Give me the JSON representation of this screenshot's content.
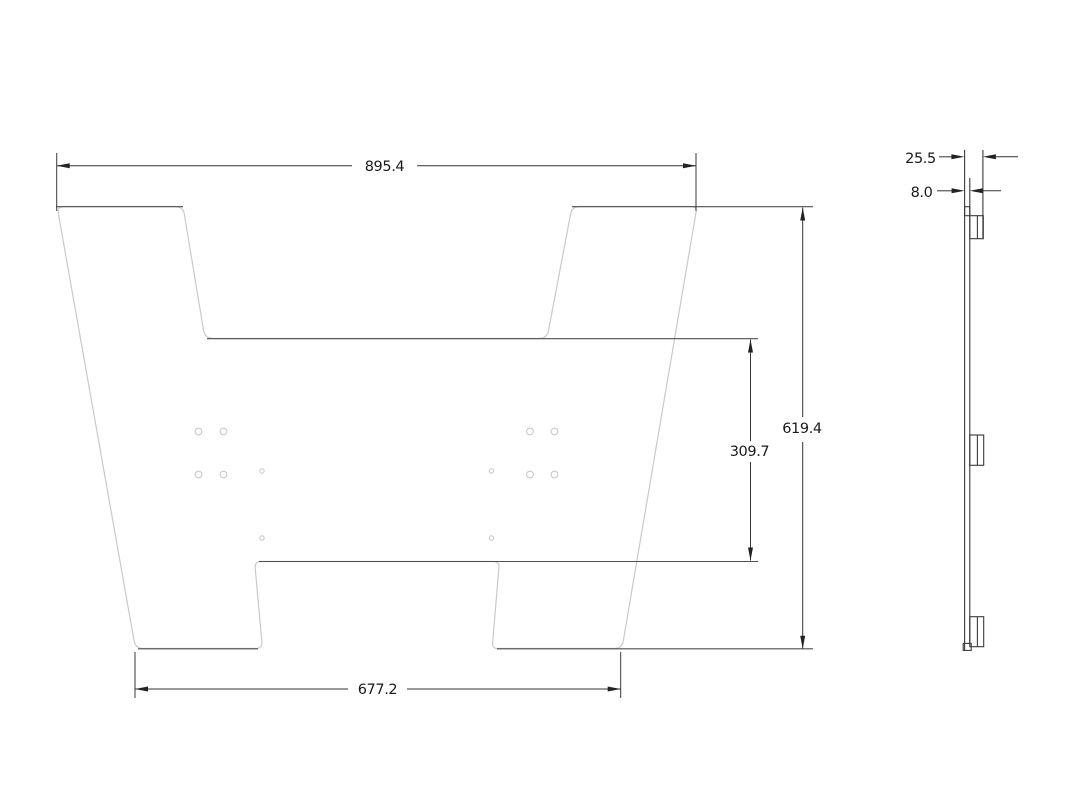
{
  "drawing": {
    "front_view": {
      "top_width": "895.4",
      "overall_height": "619.4",
      "notch_height": "309.7",
      "bottom_width": "677.2"
    },
    "side_view": {
      "overall_depth": "25.5",
      "plate_thickness": "8.0"
    },
    "colors": {
      "background": "#ffffff",
      "outline_light": "#c9c9c9",
      "outline_dark": "#4f4f4f",
      "dimension": "#333333",
      "hole_outline": "#c4c4c4"
    }
  }
}
